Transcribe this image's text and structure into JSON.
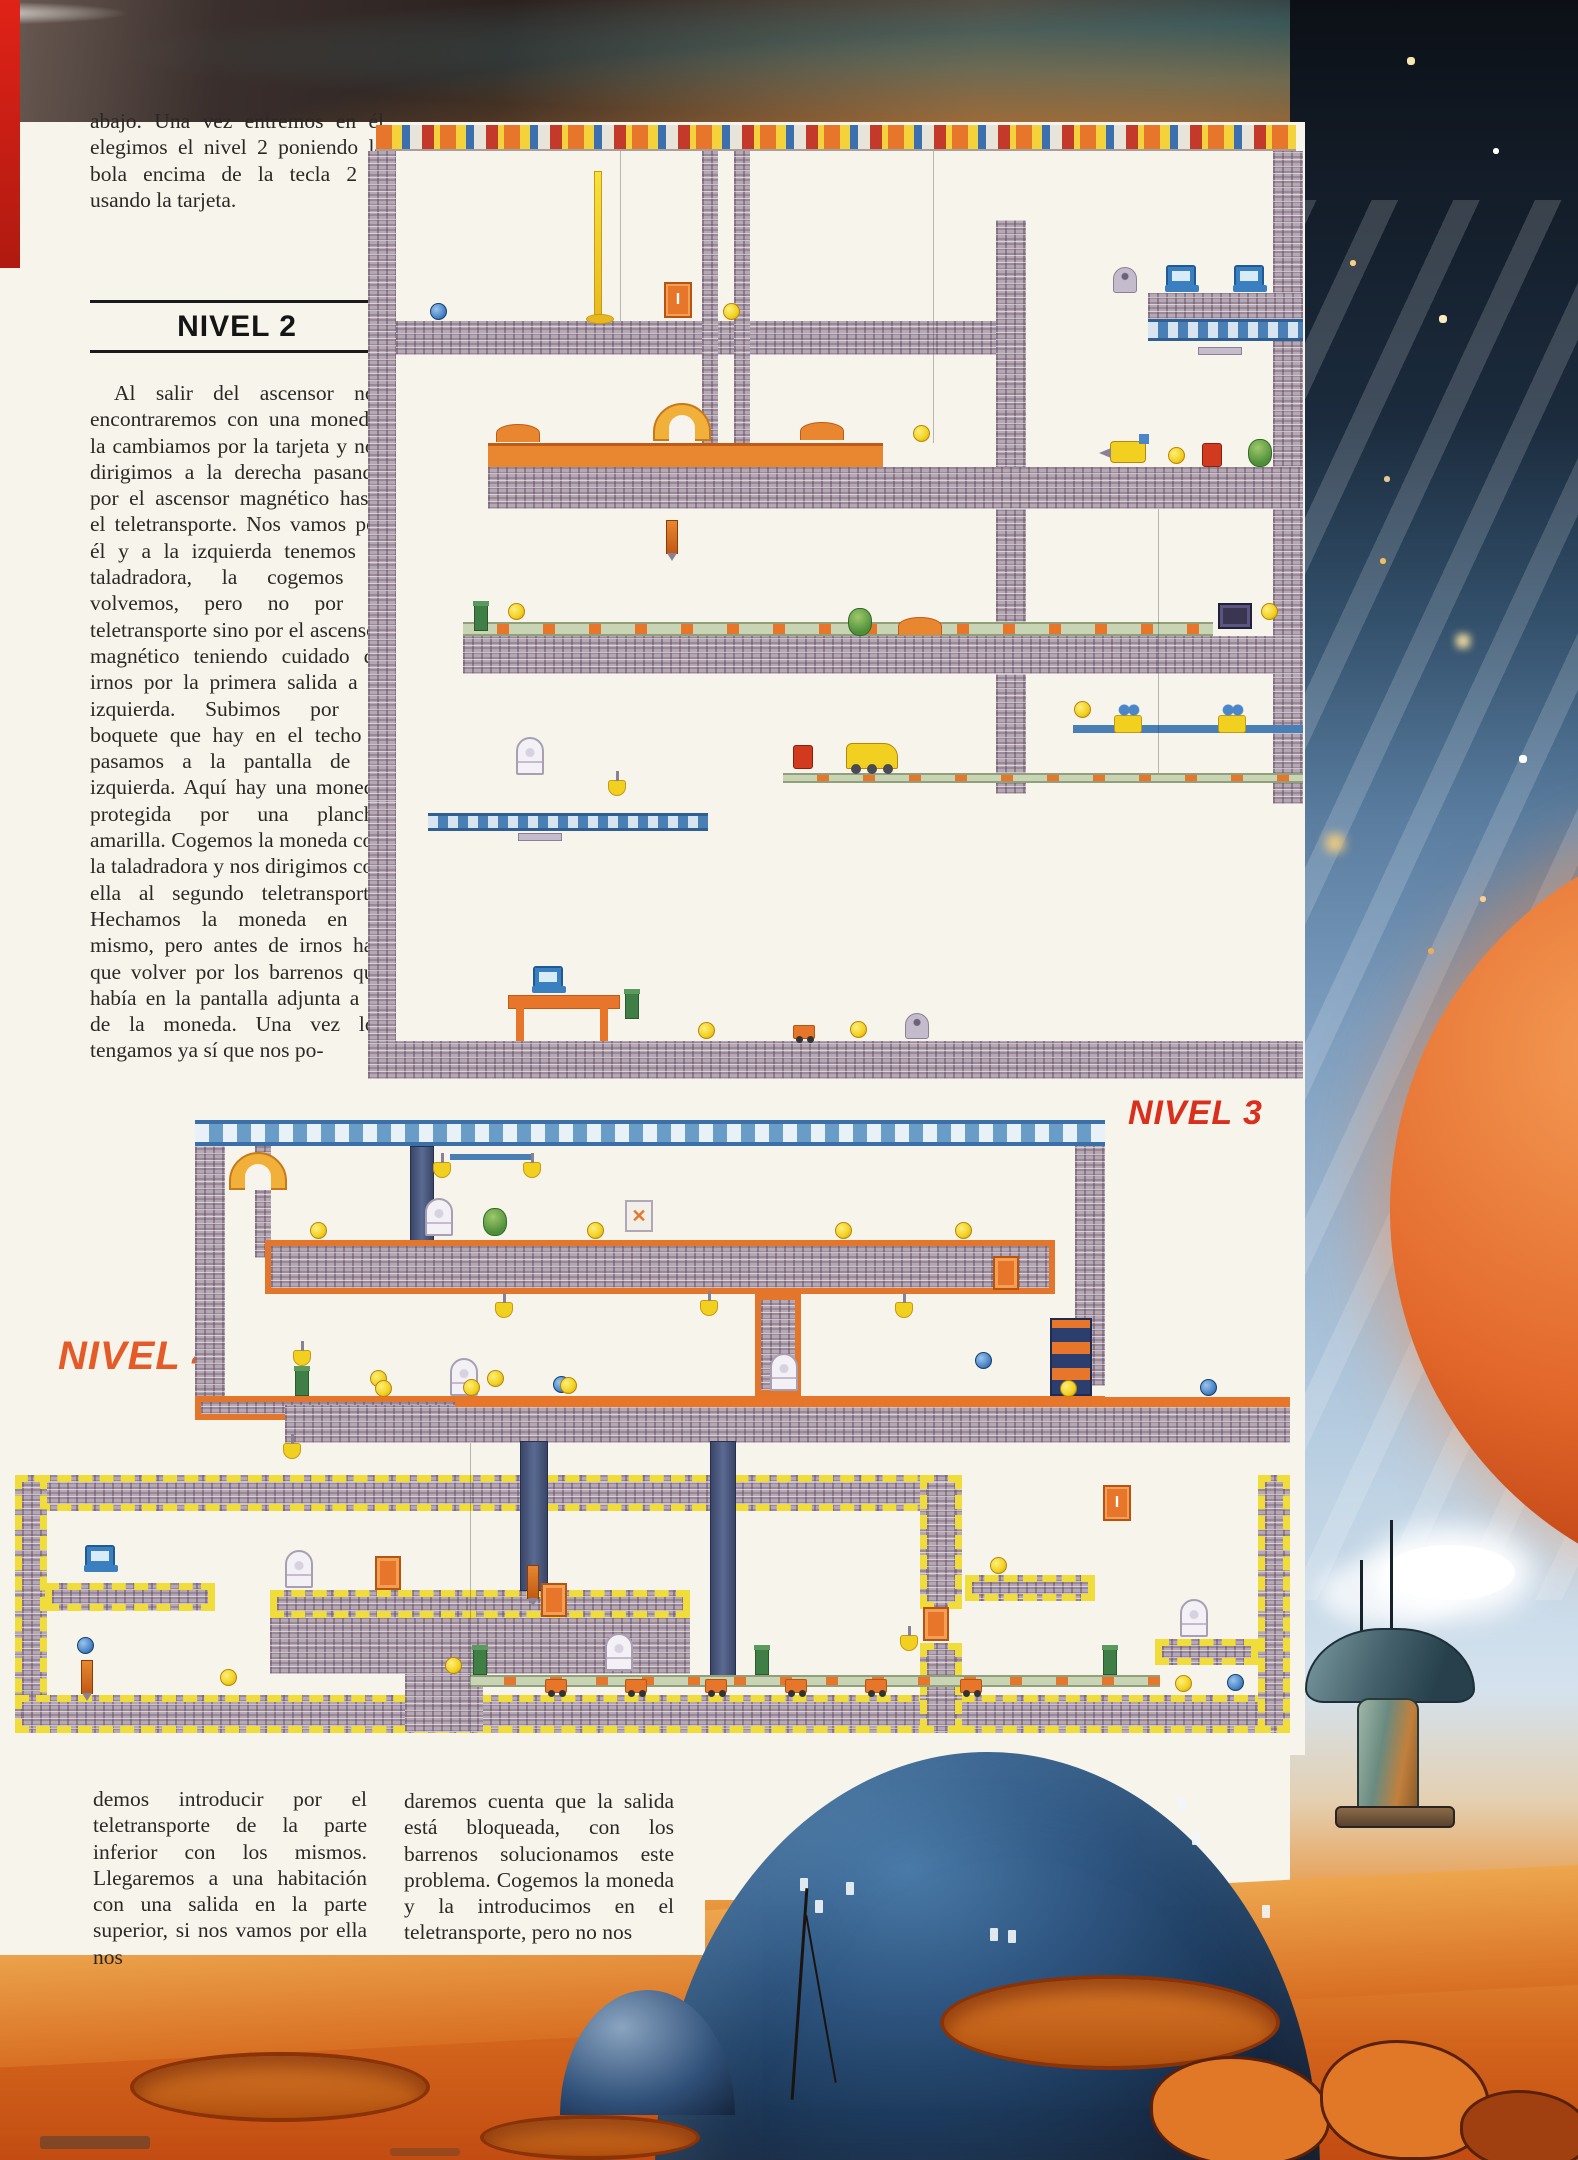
{
  "page": {
    "intro": "abajo. Una vez entremos en él elegimos el nivel 2 poniendo la bola encima de la tecla 2 y usando la tarjeta.",
    "heading": "NIVEL 2",
    "body": "Al salir del ascensor nos encontraremos con una moneda, la cambiamos por la tarjeta y nos dirigimos a la derecha pasando por el ascensor magnético hasta el teletransporte. Nos vamos por él y a la izquierda tenemos la taladradora, la cogemos y volvemos, pero no por el teletransporte sino por el ascensor magnético teniendo cuidado de irnos por la primera salida a la izquierda. Subimos por el boquete que hay en el techo y pasamos a la pantalla de la izquierda. Aquí hay una moneda protegida por una plancha amarilla. Cogemos la moneda con la taladradora y nos dirigimos con ella al segundo teletransporte. Hechamos la moneda en el mismo, pero antes de irnos hay que volver por los barrenos que había en la pantalla adjunta a la de la moneda. Una vez los tengamos ya sí que nos po-",
    "columns": {
      "left": "demos introducir por el teletransporte de la parte inferior con los mismos. Llegaremos a una habitación con una salida en la parte superior, si nos vamos por ella nos",
      "right": "daremos cuenta que la salida está bloqueada, con los barrenos solucionamos este problema. Cogemos la moneda y la introducimos en el teletransporte, pero no nos"
    },
    "labels": {
      "nivel3": "NIVEL 3",
      "nivel4": "NIVEL 4"
    }
  },
  "colors": {
    "label_red": "#d92f1d",
    "label_orange": "#e45b28",
    "brick": "#b5a8b3",
    "accent_orange": "#e8762a",
    "accent_yellow": "#f2d020"
  },
  "maps": {
    "nivel2": {
      "walls": [
        {
          "x": 8,
          "y": 0,
          "w": 920,
          "h": 26,
          "t": "decor"
        },
        {
          "x": 0,
          "y": 26,
          "w": 28,
          "h": 650,
          "t": "brick"
        },
        {
          "x": 28,
          "y": 196,
          "w": 600,
          "h": 34,
          "t": "brick"
        },
        {
          "x": 334,
          "y": 26,
          "w": 16,
          "h": 300,
          "t": "brick"
        },
        {
          "x": 366,
          "y": 26,
          "w": 16,
          "h": 300,
          "t": "brick"
        },
        {
          "x": 628,
          "y": 95,
          "w": 30,
          "h": 295,
          "t": "brick"
        },
        {
          "x": 780,
          "y": 168,
          "w": 155,
          "h": 26,
          "t": "brick"
        },
        {
          "x": 780,
          "y": 194,
          "w": 155,
          "h": 22,
          "t": "girder"
        },
        {
          "x": 905,
          "y": 26,
          "w": 30,
          "h": 142,
          "t": "brick"
        },
        {
          "x": 120,
          "y": 318,
          "w": 395,
          "h": 24,
          "t": "dirt"
        },
        {
          "x": 120,
          "y": 342,
          "w": 815,
          "h": 42,
          "t": "brick"
        },
        {
          "x": 905,
          "y": 216,
          "w": 30,
          "h": 126,
          "t": "brick"
        },
        {
          "x": 905,
          "y": 384,
          "w": 30,
          "h": 127,
          "t": "brick"
        },
        {
          "x": 628,
          "y": 384,
          "w": 30,
          "h": 127,
          "t": "brick"
        },
        {
          "x": 95,
          "y": 497,
          "w": 750,
          "h": 14,
          "t": "belt"
        },
        {
          "x": 95,
          "y": 511,
          "w": 840,
          "h": 38,
          "t": "brick"
        },
        {
          "x": 905,
          "y": 549,
          "w": 30,
          "h": 130,
          "t": "brick"
        },
        {
          "x": 628,
          "y": 549,
          "w": 30,
          "h": 120,
          "t": "brick"
        },
        {
          "x": 705,
          "y": 600,
          "w": 230,
          "h": 8,
          "t": "cable"
        },
        {
          "x": 0,
          "y": 676,
          "w": 28,
          "h": 240,
          "t": "brick"
        },
        {
          "x": 60,
          "y": 688,
          "w": 280,
          "h": 18,
          "t": "girder"
        },
        {
          "x": 415,
          "y": 648,
          "w": 520,
          "h": 10,
          "t": "belt"
        },
        {
          "x": 0,
          "y": 916,
          "w": 935,
          "h": 38,
          "t": "brick"
        },
        {
          "x": 252,
          "y": 26,
          "w": 1,
          "h": 170,
          "t": "line"
        },
        {
          "x": 565,
          "y": 26,
          "w": 1,
          "h": 292,
          "t": "line"
        },
        {
          "x": 790,
          "y": 384,
          "w": 1,
          "h": 264,
          "t": "line"
        }
      ],
      "items": [
        {
          "x": 226,
          "y": 46,
          "t": "lamp"
        },
        {
          "x": 62,
          "y": 178,
          "t": "ball"
        },
        {
          "x": 296,
          "y": 157,
          "t": "door",
          "g": "I"
        },
        {
          "x": 355,
          "y": 178,
          "t": "coin"
        },
        {
          "x": 745,
          "y": 142,
          "t": "robot"
        },
        {
          "x": 798,
          "y": 140,
          "t": "computer"
        },
        {
          "x": 866,
          "y": 140,
          "t": "computer"
        },
        {
          "x": 830,
          "y": 222,
          "t": "hoist"
        },
        {
          "x": 128,
          "y": 299,
          "t": "mound"
        },
        {
          "x": 285,
          "y": 278,
          "t": "arch"
        },
        {
          "x": 432,
          "y": 297,
          "t": "mound"
        },
        {
          "x": 545,
          "y": 300,
          "t": "coin"
        },
        {
          "x": 298,
          "y": 395,
          "t": "spike"
        },
        {
          "x": 742,
          "y": 316,
          "t": "drill"
        },
        {
          "x": 800,
          "y": 322,
          "t": "coin"
        },
        {
          "x": 834,
          "y": 318,
          "t": "redbot"
        },
        {
          "x": 880,
          "y": 314,
          "t": "creature"
        },
        {
          "x": 106,
          "y": 480,
          "t": "post"
        },
        {
          "x": 140,
          "y": 478,
          "t": "coin"
        },
        {
          "x": 893,
          "y": 478,
          "t": "coin"
        },
        {
          "x": 850,
          "y": 478,
          "t": "tv"
        },
        {
          "x": 480,
          "y": 483,
          "t": "creature"
        },
        {
          "x": 530,
          "y": 492,
          "t": "mound"
        },
        {
          "x": 746,
          "y": 590,
          "t": "pulley"
        },
        {
          "x": 850,
          "y": 590,
          "t": "pulley"
        },
        {
          "x": 706,
          "y": 576,
          "t": "coin"
        },
        {
          "x": 425,
          "y": 620,
          "t": "redbot"
        },
        {
          "x": 478,
          "y": 618,
          "t": "dozer"
        },
        {
          "x": 148,
          "y": 612,
          "t": "ghost"
        },
        {
          "x": 240,
          "y": 655,
          "t": "bell"
        },
        {
          "x": 150,
          "y": 708,
          "t": "hoist"
        },
        {
          "x": 140,
          "y": 870,
          "t": "desk"
        },
        {
          "x": 165,
          "y": 841,
          "t": "computer"
        },
        {
          "x": 257,
          "y": 868,
          "t": "post"
        },
        {
          "x": 330,
          "y": 897,
          "t": "coin"
        },
        {
          "x": 425,
          "y": 900,
          "t": "cart"
        },
        {
          "x": 537,
          "y": 888,
          "t": "robot"
        },
        {
          "x": 482,
          "y": 896,
          "t": "coin"
        }
      ]
    },
    "nivel3": {
      "walls": [
        {
          "x": 0,
          "y": 8,
          "w": 910,
          "h": 26,
          "t": "truss"
        },
        {
          "x": 0,
          "y": 34,
          "w": 30,
          "h": 274,
          "t": "brick"
        },
        {
          "x": 60,
          "y": 34,
          "w": 16,
          "h": 112,
          "t": "brick"
        },
        {
          "x": 215,
          "y": 34,
          "w": 24,
          "h": 118,
          "t": "shaft"
        },
        {
          "x": 880,
          "y": 34,
          "w": 30,
          "h": 240,
          "t": "brick"
        },
        {
          "x": 70,
          "y": 128,
          "w": 790,
          "h": 54,
          "t": "brickO"
        },
        {
          "x": 560,
          "y": 182,
          "w": 46,
          "h": 102,
          "t": "brickO"
        },
        {
          "x": 0,
          "y": 284,
          "w": 910,
          "h": 24,
          "t": "brickO"
        },
        {
          "x": 855,
          "y": 206,
          "w": 42,
          "h": 78,
          "t": "tele"
        },
        {
          "x": 255,
          "y": 42,
          "w": 82,
          "h": 6,
          "t": "cable"
        }
      ],
      "items": [
        {
          "x": 34,
          "y": 40,
          "t": "arch"
        },
        {
          "x": 238,
          "y": 50,
          "t": "bell"
        },
        {
          "x": 328,
          "y": 50,
          "t": "bell"
        },
        {
          "x": 230,
          "y": 86,
          "t": "ghost"
        },
        {
          "x": 288,
          "y": 96,
          "t": "creature"
        },
        {
          "x": 430,
          "y": 88,
          "t": "signx",
          "g": "✕"
        },
        {
          "x": 115,
          "y": 110,
          "t": "coin"
        },
        {
          "x": 392,
          "y": 110,
          "t": "coin"
        },
        {
          "x": 640,
          "y": 110,
          "t": "coin"
        },
        {
          "x": 760,
          "y": 110,
          "t": "coin"
        },
        {
          "x": 798,
          "y": 144,
          "t": "crate"
        },
        {
          "x": 98,
          "y": 238,
          "t": "bell"
        },
        {
          "x": 100,
          "y": 258,
          "t": "post"
        },
        {
          "x": 300,
          "y": 190,
          "t": "bell"
        },
        {
          "x": 505,
          "y": 188,
          "t": "bell"
        },
        {
          "x": 700,
          "y": 190,
          "t": "bell"
        },
        {
          "x": 255,
          "y": 246,
          "t": "ghost"
        },
        {
          "x": 175,
          "y": 258,
          "t": "coin"
        },
        {
          "x": 292,
          "y": 258,
          "t": "coin"
        },
        {
          "x": 358,
          "y": 264,
          "t": "ball"
        },
        {
          "x": 780,
          "y": 240,
          "t": "ball"
        }
      ]
    },
    "nivel4": {
      "walls": [
        {
          "x": 270,
          "y": 20,
          "w": 1005,
          "h": 38,
          "t": "brick"
        },
        {
          "x": 440,
          "y": 12,
          "w": 835,
          "h": 10,
          "t": "orange"
        },
        {
          "x": 0,
          "y": 90,
          "w": 945,
          "h": 36,
          "t": "brickY"
        },
        {
          "x": 0,
          "y": 90,
          "w": 32,
          "h": 258,
          "t": "brickY"
        },
        {
          "x": 0,
          "y": 310,
          "w": 1275,
          "h": 38,
          "t": "brickY"
        },
        {
          "x": 1243,
          "y": 90,
          "w": 32,
          "h": 258,
          "t": "brickY"
        },
        {
          "x": 905,
          "y": 90,
          "w": 42,
          "h": 134,
          "t": "brickY"
        },
        {
          "x": 905,
          "y": 258,
          "w": 42,
          "h": 90,
          "t": "brickY"
        },
        {
          "x": 30,
          "y": 198,
          "w": 170,
          "h": 28,
          "t": "brickY"
        },
        {
          "x": 255,
          "y": 205,
          "w": 420,
          "h": 28,
          "t": "brickY"
        },
        {
          "x": 255,
          "y": 233,
          "w": 420,
          "h": 56,
          "t": "brick"
        },
        {
          "x": 390,
          "y": 289,
          "w": 78,
          "h": 58,
          "t": "brick"
        },
        {
          "x": 505,
          "y": 56,
          "w": 28,
          "h": 150,
          "t": "shaft"
        },
        {
          "x": 695,
          "y": 56,
          "w": 26,
          "h": 235,
          "t": "shaft"
        },
        {
          "x": 950,
          "y": 190,
          "w": 130,
          "h": 26,
          "t": "brickY"
        },
        {
          "x": 1140,
          "y": 254,
          "w": 103,
          "h": 26,
          "t": "brickY"
        },
        {
          "x": 455,
          "y": 290,
          "w": 690,
          "h": 12,
          "t": "belt"
        },
        {
          "x": 455,
          "y": 58,
          "w": 1,
          "h": 290,
          "t": "line"
        }
      ],
      "items": [
        {
          "x": 360,
          "y": -5,
          "t": "coin"
        },
        {
          "x": 448,
          "y": -6,
          "t": "coin"
        },
        {
          "x": 545,
          "y": -8,
          "t": "coin"
        },
        {
          "x": 755,
          "y": -32,
          "t": "ghost"
        },
        {
          "x": 1045,
          "y": -5,
          "t": "coin"
        },
        {
          "x": 1185,
          "y": -6,
          "t": "ball"
        },
        {
          "x": 268,
          "y": 58,
          "t": "bell"
        },
        {
          "x": 70,
          "y": 160,
          "t": "computer"
        },
        {
          "x": 270,
          "y": 165,
          "t": "ghost"
        },
        {
          "x": 360,
          "y": 171,
          "t": "crate"
        },
        {
          "x": 526,
          "y": 198,
          "t": "crate"
        },
        {
          "x": 512,
          "y": 180,
          "t": "spike"
        },
        {
          "x": 908,
          "y": 222,
          "t": "crate"
        },
        {
          "x": 1088,
          "y": 100,
          "t": "door",
          "g": "I"
        },
        {
          "x": 975,
          "y": 172,
          "t": "coin"
        },
        {
          "x": 1165,
          "y": 214,
          "t": "ghost"
        },
        {
          "x": 62,
          "y": 252,
          "t": "ball"
        },
        {
          "x": 66,
          "y": 275,
          "t": "spike"
        },
        {
          "x": 205,
          "y": 284,
          "t": "coin"
        },
        {
          "x": 430,
          "y": 272,
          "t": "coin"
        },
        {
          "x": 590,
          "y": 248,
          "t": "ghost"
        },
        {
          "x": 458,
          "y": 264,
          "t": "post"
        },
        {
          "x": 740,
          "y": 264,
          "t": "post"
        },
        {
          "x": 1088,
          "y": 264,
          "t": "post"
        },
        {
          "x": 530,
          "y": 294,
          "t": "cart"
        },
        {
          "x": 610,
          "y": 294,
          "t": "cart"
        },
        {
          "x": 690,
          "y": 294,
          "t": "cart"
        },
        {
          "x": 770,
          "y": 294,
          "t": "cart"
        },
        {
          "x": 850,
          "y": 294,
          "t": "cart"
        },
        {
          "x": 945,
          "y": 294,
          "t": "cart"
        },
        {
          "x": 885,
          "y": 250,
          "t": "bell"
        },
        {
          "x": 1160,
          "y": 290,
          "t": "coin"
        },
        {
          "x": 1212,
          "y": 289,
          "t": "ball"
        }
      ]
    }
  }
}
